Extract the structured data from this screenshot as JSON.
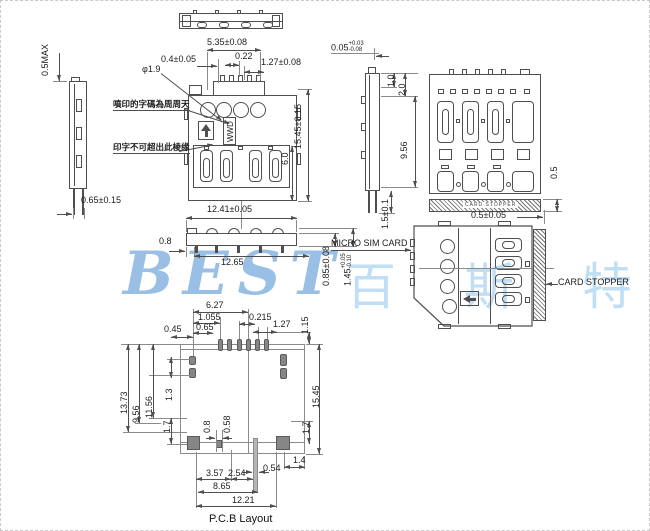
{
  "watermark": {
    "latin": "BEST",
    "cjk": "百斯特"
  },
  "side_view_left": {
    "dim_top": "0.5MAX",
    "dim_bottom": "0.65±0.15"
  },
  "front_view": {
    "dim_group": "5.35±0.08",
    "dim_offset": "0.4±0.05",
    "dim_pin": "0.22",
    "dim_pitch": "1.27±0.08",
    "dim_hole": "φ1.9",
    "note1": "噴印的字碼為周周天",
    "note2": "印字不可超出此棱缘",
    "marking": "WWD",
    "dim_height": "15.45±0.15",
    "dim_lower": "6.0"
  },
  "side_view_right": {
    "dim_top": "0.05",
    "tol_plus": "+0.03",
    "tol_minus": "-0.08",
    "dim_a": "1.0",
    "dim_b": "2.0",
    "dim_c": "9.56",
    "dim_leg": "1.5±0.1"
  },
  "rear_view": {
    "stopper_text": "CARD STOPPER",
    "dim_thk": "0.5",
    "dim_gap": "0.5±0.05"
  },
  "edge_view": {
    "dim_w1": "12.41±0.05",
    "dim_tab": "0.8",
    "dim_w2": "12.65",
    "dim_h1": "0.85±0.08",
    "dim_h2": "1.45",
    "tol_plus": "+0.05",
    "tol_minus": "-0.10"
  },
  "card_view": {
    "label_card": "MICRO SIM CARD",
    "label_stopper": "CARD STOPPER"
  },
  "pcb": {
    "caption": "P.C.B Layout",
    "d045": "0.45",
    "d627": "6.27",
    "d1055": "1.055",
    "d065": "0.65",
    "d0215": "0.215",
    "d127": "1.27",
    "d115": "1.15",
    "d1373": "13.73",
    "d956": "9.56",
    "d1156": "11.56",
    "d13": "1.3",
    "d17l": "1.7",
    "d08": "0.8",
    "d058": "0.58",
    "d1545": "15.45",
    "d17r": "1.7",
    "d14": "1.4",
    "d357": "3.57",
    "d254": "2.54",
    "d054": "0.54",
    "d865": "8.65",
    "d1221": "12.21"
  }
}
